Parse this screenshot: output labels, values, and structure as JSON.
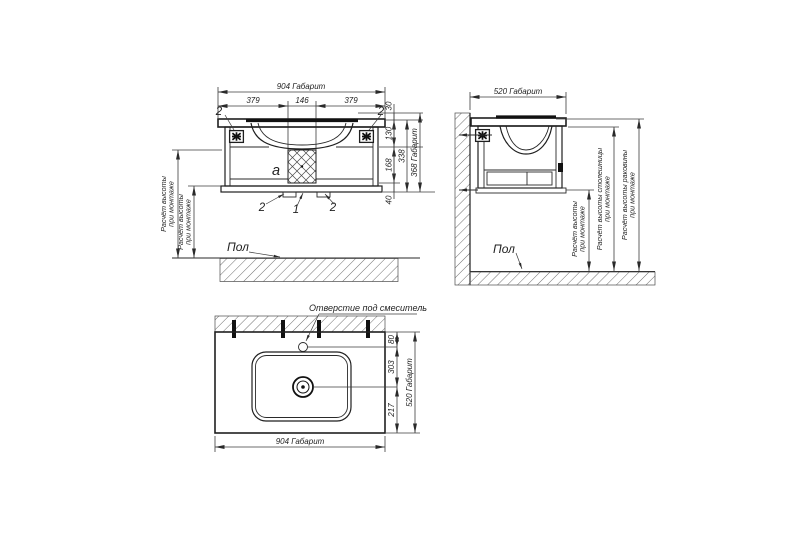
{
  "front_view": {
    "dim_overall_width": "904 Габарит",
    "dim_left": "379",
    "dim_center": "146",
    "dim_right": "379",
    "dim_rim": "30",
    "dim_top_section": "130",
    "dim_mid_section": "168",
    "dim_foot": "40",
    "dim_body": "338",
    "dim_overall_height": "368 Габарит",
    "callout_bracket_left": "2",
    "callout_bracket_right": "2",
    "callout_tab_left": "2",
    "callout_center": "1",
    "callout_tab_right": "2",
    "label_section": "a",
    "label_floor": "Пол",
    "dim_mount_a": {
      "line1": "Расчёт высоты",
      "line2": "при монтаже"
    },
    "dim_mount_b": {
      "line1": "Расчёт высоты",
      "line2": "при монтаже"
    }
  },
  "side_view": {
    "dim_overall_depth": "520 Габарит",
    "label_floor": "Пол",
    "dim_mount": {
      "line1": "Расчёт высоты",
      "line2": "при монтаже"
    },
    "dim_countertop": {
      "line1": "Расчёт высоты столешницы",
      "line2": "при монтаже"
    },
    "dim_basin": {
      "line1": "Расчёт высоты раковины",
      "line2": "при монтаже"
    }
  },
  "top_view": {
    "label_faucet_hole": "Отверстие под смеситель",
    "dim_hole_offset": "80",
    "dim_hole_to_drain": "303",
    "dim_drain_to_front": "217",
    "dim_overall_depth": "520 Габарит",
    "dim_overall_width": "904 Габарит"
  }
}
